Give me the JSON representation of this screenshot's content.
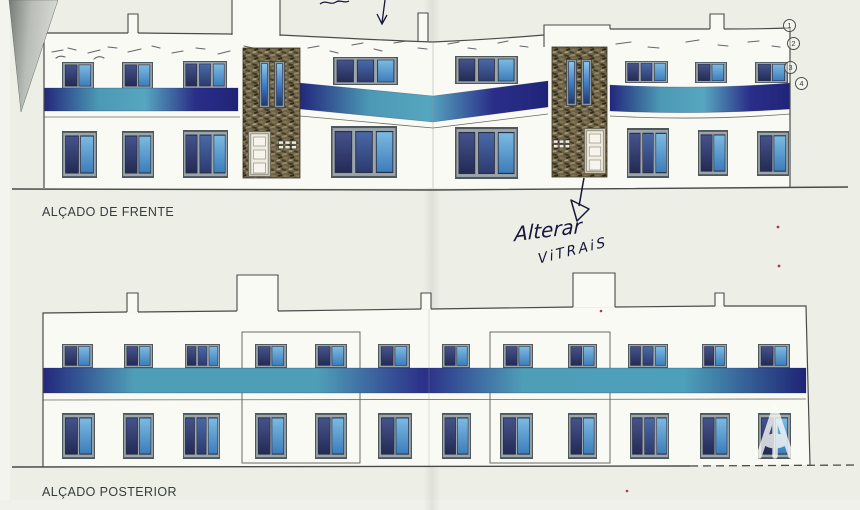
{
  "labels": {
    "front": "ALÇADO DE FRENTE",
    "rear": "ALÇADO POSTERIOR"
  },
  "handwriting": {
    "line1": "Alterar",
    "line2": "ViTRAiS"
  },
  "callouts": [
    "1",
    "2",
    "3",
    "4"
  ],
  "watermark": {
    "letter": "A"
  },
  "colors": {
    "paper": "#edefe7",
    "facade": "#f9faf4",
    "line": "#4a4a4a",
    "band_indigo": "#23277c",
    "band_teal": "#4f9eb8",
    "pane_dark": "#2c3564",
    "pane_light": "#4f9bd2",
    "frame_gray": "#9ba6ab",
    "stone_brown": "#6e6349",
    "ink": "#16163a",
    "corner_gray": "#b9bdb7",
    "red_speck": "#93202e"
  }
}
